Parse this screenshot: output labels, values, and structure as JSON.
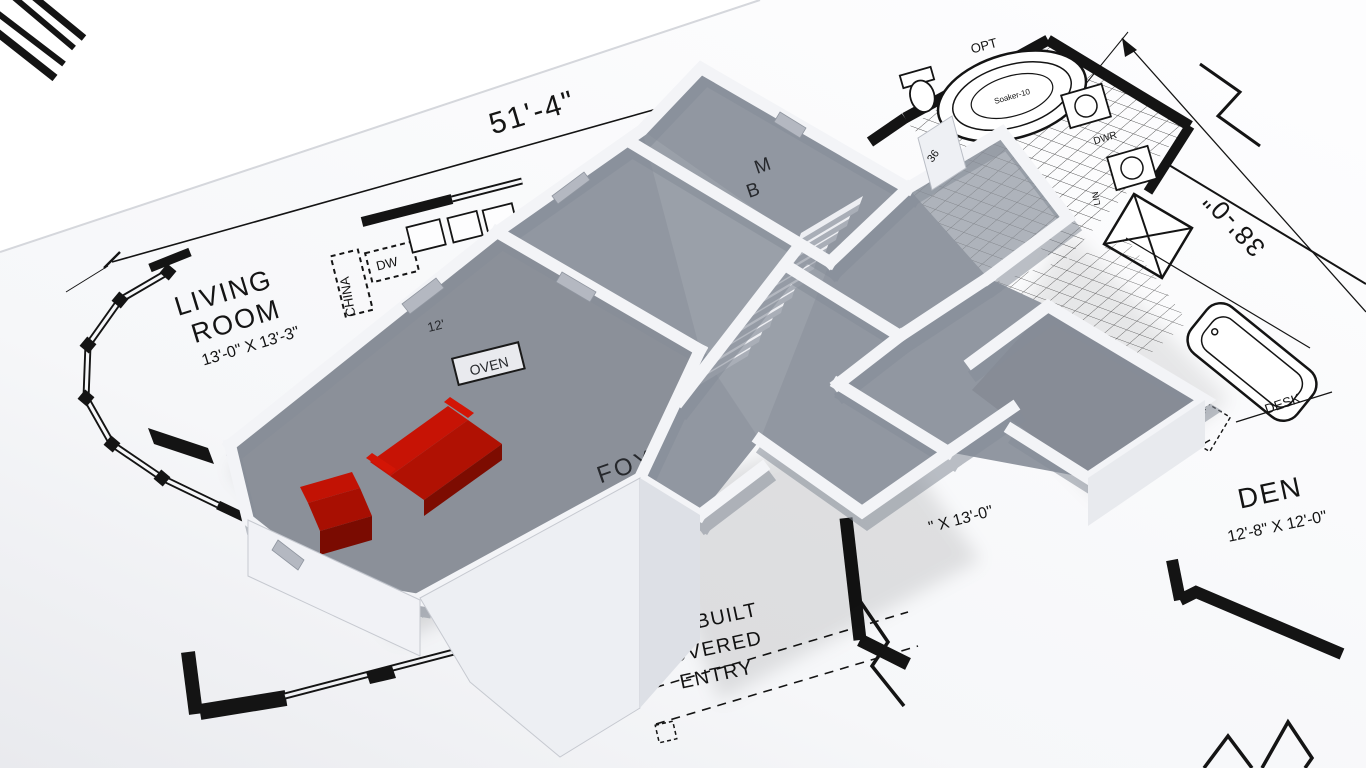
{
  "scene": {
    "type": "3d-floorplan-render-on-blueprint"
  },
  "colors": {
    "background": "#ffffff",
    "paper": "#f7f8fa",
    "ink": "#141414",
    "wall_top": "#f3f4f7",
    "wall_shadow": "#868d98",
    "floor_gray": "#9197a1",
    "sofa_red": "#c71305",
    "sofa_red_dark": "#7d0c01"
  },
  "labels": {
    "dim_top": "51'-4\"",
    "dim_right": "38'-0\"",
    "living_room": {
      "line1": "LIVING",
      "line2": "ROOM",
      "size": "13'-0\" X 13'-3\""
    },
    "den": {
      "name": "DEN",
      "size": "12'-8\" X 12'-0\""
    },
    "entry": {
      "line1": "SITE BUILT",
      "line2": "COVERED",
      "line3": "ENTRY"
    },
    "foyer": "FOY",
    "master": {
      "line1": "M",
      "line2": "B"
    },
    "hidden_size": "\" X 13'-0\"",
    "bath": {
      "opt": "OPT",
      "soaker": "Soaker-10",
      "name": "BA 1",
      "dwr": "DWR"
    },
    "kitchen": {
      "china": "CHINA",
      "dw": "DW",
      "oven": "OVEN",
      "twelve": "12'"
    },
    "den_side": {
      "desk": "DESK",
      "wc": "WC",
      "lin": "LIN",
      "w17": "W 17",
      "six3": "6'-3\""
    },
    "marks": {
      "n36a": "36",
      "n36b": "36",
      "n36c": "36"
    }
  }
}
